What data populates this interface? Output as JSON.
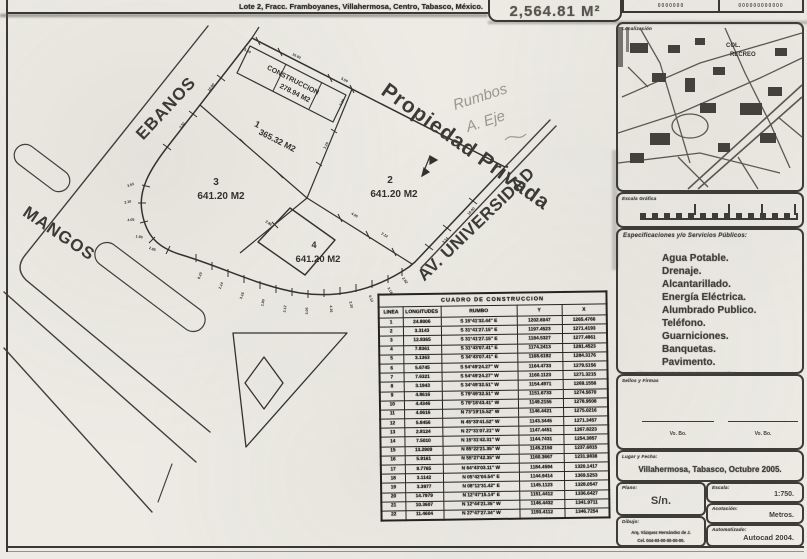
{
  "header": {
    "title": "Lote 2, Fracc. Framboyanes, Villahermosa, Centro, Tabasco, México.",
    "area_total": "2,564.81 M²",
    "code1": "0000000",
    "code2": "000000000000"
  },
  "plan": {
    "street_ebanos": "EBANOS",
    "street_mangos": "MANGOS",
    "street_av": "AV. UNIVERSIDAD",
    "private_label": "Propiedad Privada",
    "construction_line1": "CONSTRUCCION",
    "construction_line2": "278.94 M2",
    "lot1_num": "1",
    "lot1_area": "365.32 M2",
    "lot2_num": "2",
    "lot2_area": "641.20 M2",
    "lot3_num": "3",
    "lot3_area": "641.20 M2",
    "lot4_num": "4",
    "lot4_area": "641.20 M2",
    "note_line1": "Rumbos",
    "note_line2": "A. Eje",
    "dims": [
      {
        "t": "8.10",
        "x": 201,
        "y": 276,
        "r": -70
      },
      {
        "t": "2.14",
        "x": 222,
        "y": 286,
        "r": -70
      },
      {
        "t": "3.16",
        "x": 243,
        "y": 296,
        "r": -72
      },
      {
        "t": "1.80",
        "x": 264,
        "y": 303,
        "r": -78
      },
      {
        "t": "2.12",
        "x": 286,
        "y": 309,
        "r": -84
      },
      {
        "t": "3.05",
        "x": 308,
        "y": 311,
        "r": -88
      },
      {
        "t": "4.16",
        "x": 330,
        "y": 309,
        "r": 85
      },
      {
        "t": "2.20",
        "x": 350,
        "y": 305,
        "r": 78
      },
      {
        "t": "6.12",
        "x": 370,
        "y": 299,
        "r": 70
      },
      {
        "t": "3.18",
        "x": 389,
        "y": 291,
        "r": 62
      },
      {
        "t": "2.62",
        "x": 404,
        "y": 281,
        "r": 55
      },
      {
        "t": "3.53",
        "x": 131,
        "y": 186,
        "r": -20
      },
      {
        "t": "2.10",
        "x": 128,
        "y": 203,
        "r": -12
      },
      {
        "t": "4.05",
        "x": 131,
        "y": 221,
        "r": -5
      },
      {
        "t": "1.90",
        "x": 139,
        "y": 238,
        "r": 8
      },
      {
        "t": "2.85",
        "x": 152,
        "y": 250,
        "r": 20
      },
      {
        "t": "10.00",
        "x": 212,
        "y": 88,
        "r": -52
      },
      {
        "t": "3.53",
        "x": 183,
        "y": 126,
        "r": -52
      },
      {
        "t": "10.00",
        "x": 296,
        "y": 57,
        "r": 27
      },
      {
        "t": "5.50",
        "x": 344,
        "y": 81,
        "r": 27
      },
      {
        "t": "3.10",
        "x": 327,
        "y": 146,
        "r": -65
      },
      {
        "t": "4.00",
        "x": 354,
        "y": 216,
        "r": 30
      },
      {
        "t": "2.12",
        "x": 384,
        "y": 236,
        "r": 30
      },
      {
        "t": "10.00",
        "x": 472,
        "y": 212,
        "r": -47
      },
      {
        "t": "3.14",
        "x": 446,
        "y": 241,
        "r": -47
      },
      {
        "t": "5.50",
        "x": 247,
        "y": 52,
        "r": 27
      },
      {
        "t": "3.20",
        "x": 343,
        "y": 103,
        "r": -63
      },
      {
        "t": "2.86",
        "x": 268,
        "y": 224,
        "r": 33
      }
    ]
  },
  "table": {
    "title": "CUADRO DE CONSTRUCCION",
    "headers": [
      "LINEA",
      "LONGITUDES",
      "RUMBO",
      "Y",
      "X"
    ],
    "rows": [
      [
        "1",
        "24.8006",
        "S 15°41'32.44\" E",
        "1202.6047",
        "1265.4766"
      ],
      [
        "2",
        "3.3143",
        "S 31°41'27.15\" E",
        "1197.4523",
        "1271.4193"
      ],
      [
        "3",
        "12.8365",
        "S 31°41'27.15\" E",
        "1184.5327",
        "1277.4861"
      ],
      [
        "4",
        "7.8361",
        "S 31°43'07.41\" E",
        "1174.2413",
        "1281.4523"
      ],
      [
        "5",
        "3.1363",
        "S 34°43'07.41\" E",
        "1168.6192",
        "1284.3176"
      ],
      [
        "6",
        "5.6745",
        "S 54°49'24.27\" W",
        "1164.4733",
        "1279.5156"
      ],
      [
        "7",
        "7.6321",
        "S 54°49'24.27\" W",
        "1160.1123",
        "1271.3215"
      ],
      [
        "8",
        "3.1943",
        "S 34°49'32.51\" W",
        "1154.4971",
        "1269.1556"
      ],
      [
        "9",
        "4.8616",
        "S 79°49'32.51\" W",
        "1151.6733",
        "1274.5670"
      ],
      [
        "10",
        "4.4346",
        "S 79°18'43.41\" W",
        "1149.2155",
        "1278.9508"
      ],
      [
        "11",
        "4.0616",
        "N 73°19'15.52\" W",
        "1146.4421",
        "1275.0216"
      ],
      [
        "12",
        "5.8456",
        "N 45°33'41.52\" W",
        "1143.3445",
        "1271.3457"
      ],
      [
        "13",
        "2.8124",
        "N 27°31'07.21\" W",
        "1147.4451",
        "1267.8223"
      ],
      [
        "14",
        "7.5010",
        "N 15°31'42.31\" W",
        "1144.7431",
        "1254.3857"
      ],
      [
        "15",
        "13.2909",
        "N 85°22'21.35\" W",
        "1145.2150",
        "1237.6815"
      ],
      [
        "16",
        "5.9161",
        "N 55°27'42.35\" W",
        "1160.3667",
        "1231.9838"
      ],
      [
        "17",
        "8.7765",
        "N 64°43'03.11\" W",
        "1184.4594",
        "1320.1417"
      ],
      [
        "18",
        "3.1142",
        "N 05°42'04.54\" E",
        "1144.9414",
        "1369.5253"
      ],
      [
        "19",
        "3.3977",
        "N 08°12'31.42\" E",
        "1145.1123",
        "1328.0547"
      ],
      [
        "20",
        "14.7979",
        "N 12°47'15.14\" E",
        "1151.4412",
        "1336.6427"
      ],
      [
        "21",
        "10.3607",
        "N 12°44'21.35\" W",
        "1146.4432",
        "1341.9711"
      ],
      [
        "22",
        "11.4604",
        "N 27°47'27.34\" W",
        "1193.4112",
        "1346.7254"
      ]
    ]
  },
  "sidebar": {
    "localizacion_label": "Localización",
    "map_label_line1": "COL.",
    "map_label_line2": "RECREO",
    "escala_grafica_label": "Escala Gráfica",
    "servicios_heading": "Especificaciones y/o Servicios Públicos:",
    "services": [
      "Agua Potable.",
      "Drenaje.",
      "Alcantarillado.",
      "Energía Eléctrica.",
      "Alumbrado Publico.",
      "Teléfono.",
      "Guarniciones.",
      "Banquetas.",
      "Pavimento."
    ],
    "services_note": "(Información determinada en levantamiento topográfico)",
    "sellos_label": "Sellos y Firmas",
    "vobo_left": "Vo. Bo.",
    "vobo_right": "Vo. Bo.",
    "lugar_label": "Lugar y Fecha:",
    "lugar_value": "Villahermosa, Tabasco, Octubre 2005.",
    "plano_label": "Plano:",
    "plano_value": "S/n.",
    "dibujo_label": "Dibujo:",
    "dibujo_line1": "Arq. Vázquez Hernández de J.",
    "dibujo_line2": "Cel. 044-93-00-00-00-00.",
    "escala_label": "Escala:",
    "escala_value": "1:750.",
    "acotacion_label": "Acotación:",
    "acotacion_value": "Metros.",
    "automatizado_label": "Automatizado:",
    "automatizado_value": "Autocad 2004."
  }
}
